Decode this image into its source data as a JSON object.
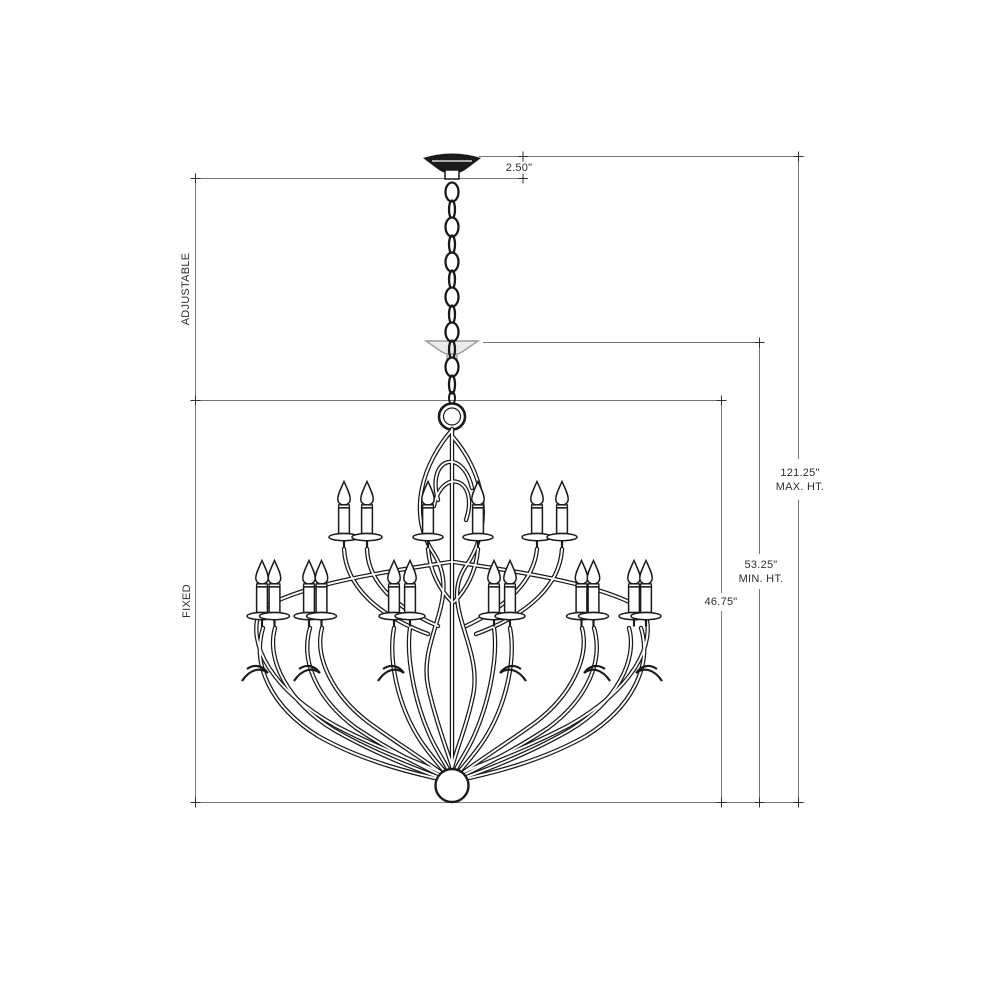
{
  "diagram": {
    "description": "Chandelier installation dimension line drawing",
    "section_labels": {
      "adjustable": "ADJUSTABLE",
      "fixed": "FIXED"
    },
    "dimensions": {
      "canopy_drop": {
        "value": "2.50\""
      },
      "max_height": {
        "value": "121.25\"",
        "caption": "MAX. HT."
      },
      "min_height": {
        "value": "53.25\"",
        "caption": "MIN. HT."
      },
      "fixture_height": {
        "value": "46.75\""
      }
    },
    "colors": {
      "background": "#ffffff",
      "drawing_line": "#1a1a1a",
      "dimension_line": "#777777",
      "ghost_line": "#9a9a9a",
      "label_text": "#2e2e2e"
    }
  }
}
